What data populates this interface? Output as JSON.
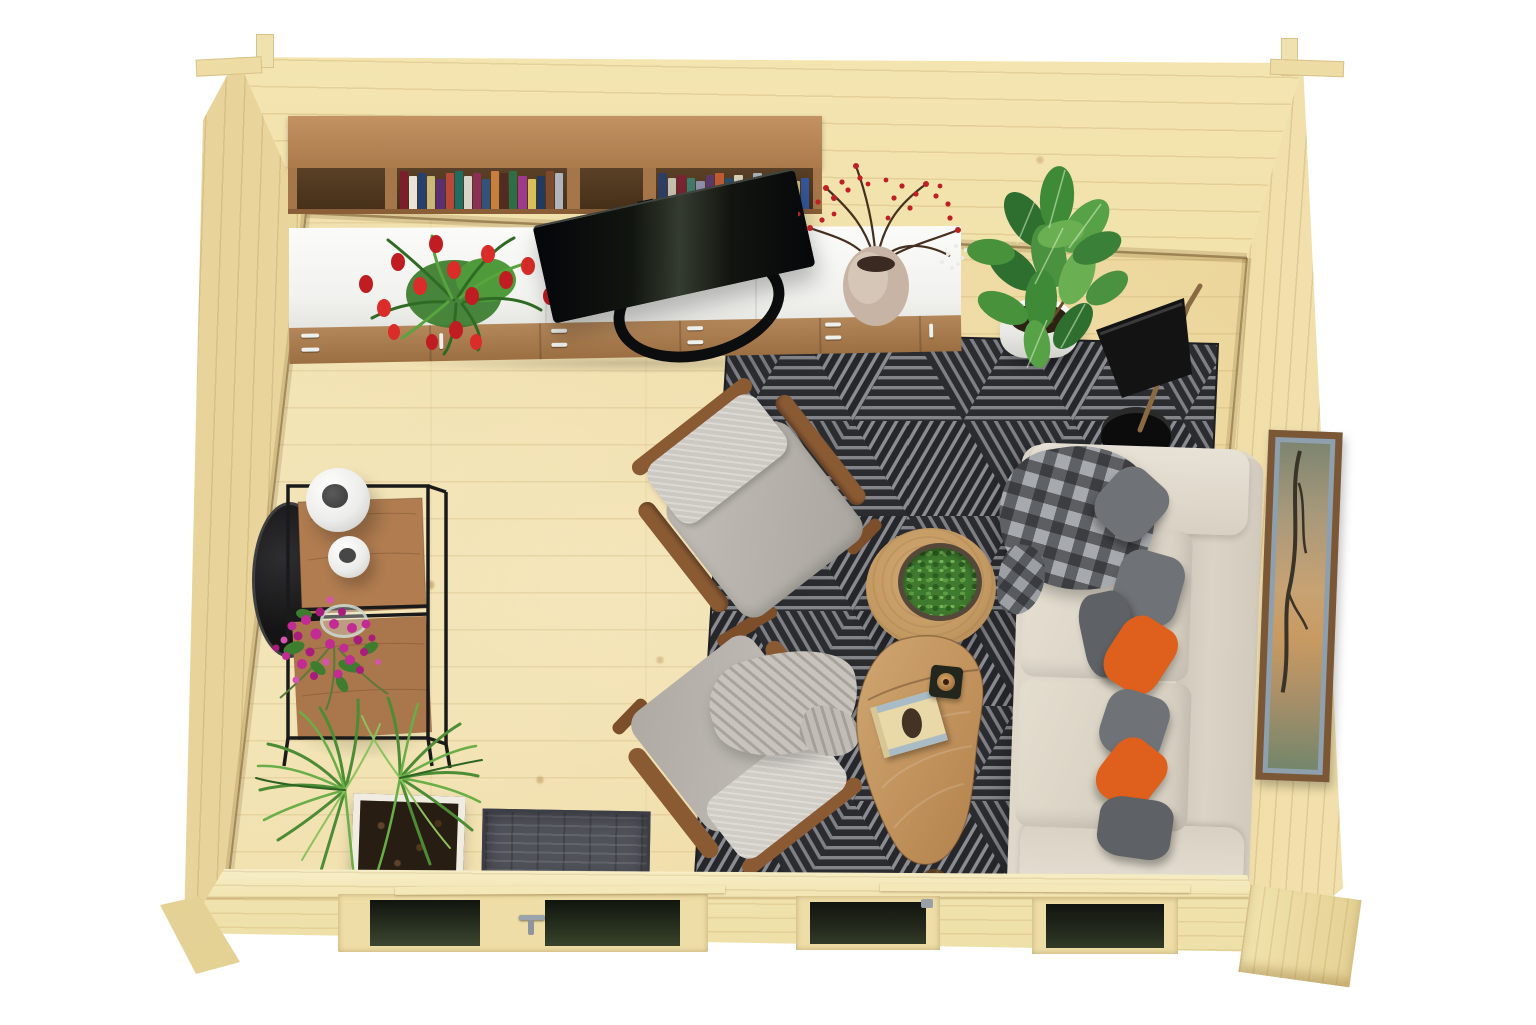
{
  "scene": {
    "label": "Top-down 3D render of a small log cabin interior furnished as a living room with sofa, armchairs, rug, shelving and plants",
    "background_color": "#ffffff"
  },
  "palette": {
    "floor_pine": "#f0e0ad",
    "wall_pine": "#edd9a2",
    "wall_plate": "#f6ecc2",
    "shelf_wood": "#b07f4f",
    "cabinet_white": "#f5f5f2",
    "drawer_wood": "#a97b4f",
    "tv_black": "#101311",
    "rug_base": "#2b2c30",
    "rug_stripe": "#83858a",
    "sofa_cream": "#ded7c9",
    "pillow_gray": "#6f7276",
    "pillow_dark_gray": "#5e6165",
    "pillow_orange": "#df5f1c",
    "chair_gray": "#b6b2ab",
    "chair_wood": "#8a5a33",
    "table_wood": "#c49a63",
    "plant_green": "#47923b",
    "tulip_red": "#c41e22",
    "flower_magenta": "#c22b93",
    "lamp_black": "#141414",
    "doormat_gray": "#50525a",
    "frame_brown": "#7a5533",
    "glazing_dark": "#1c2016"
  },
  "objects": {
    "floor": "Light pine wood plank floor",
    "back_wall": "Back log wall",
    "left_wall": "Left log wall",
    "right_wall": "Right log wall",
    "front_wall": "Front wall with glazed double door and two windows",
    "bookshelf": "Wall mounted oak shelf with books",
    "sideboard": "Long white sideboard with oak drawers",
    "tv": "Flat screen TV lying at an angle on the sideboard",
    "tulips": "Bouquet of red tulips",
    "berry_vase": "Ceramic vase with red berry branches",
    "ficus": "Potted ficus plant in white pot",
    "floor_lamp": "Black cone floor lamp",
    "rug": "Dark grey rug with striped triangle pattern",
    "armchair_top": "Grey fabric armchair with wooden frame",
    "armchair_bottom": "Grey fabric armchair with throw blanket",
    "throw_blanket": "Light grey herringbone throw",
    "round_table": "Round wooden coffee table with bowl of greenery",
    "kidney_table": "Kidney shaped wooden coffee table",
    "book": "Book with rabbit cover",
    "candle": "Square candle holder",
    "sofa": "Cream three seat sofa",
    "sofa_blanket": "Checked grey blanket over the armrest",
    "pillows": "Grey and orange scatter cushions",
    "picture_frame": "Framed artwork on the right wall",
    "console": "Black metal console shelf with wooden panels",
    "mirror": "Round black mirror leaning on the left wall",
    "bouquet": "Magenta flowers in a glass vase",
    "white_vases": "Two white sphere vases",
    "palm": "Potted fan palm",
    "doormat": "Dark grey doormat",
    "door": "Glazed double door",
    "window_a": "Front window left",
    "window_b": "Front window right"
  },
  "books": {
    "group1": [
      "#7a1f2b",
      "#e8e4da",
      "#27406e",
      "#c8b97a",
      "#5c2f6e",
      "#b5493a",
      "#1f6e63",
      "#d9d4c8",
      "#8c2f57",
      "#32527b",
      "#c77f3e",
      "#512d21",
      "#2e6d46",
      "#9e3a8c",
      "#d7c05a",
      "#223a5e",
      "#7d4a2b",
      "#b0b4bb"
    ],
    "group2": [
      "#2c3e63",
      "#c5bfae",
      "#7a2332",
      "#3f7a6a",
      "#8e8fa8",
      "#5b3a69",
      "#bd5b35",
      "#24506e",
      "#d9cfb8",
      "#6e2a4b",
      "#a8b2b8",
      "#433020",
      "#2f6d52",
      "#b4434f",
      "#cfc06a",
      "#35589e"
    ]
  }
}
